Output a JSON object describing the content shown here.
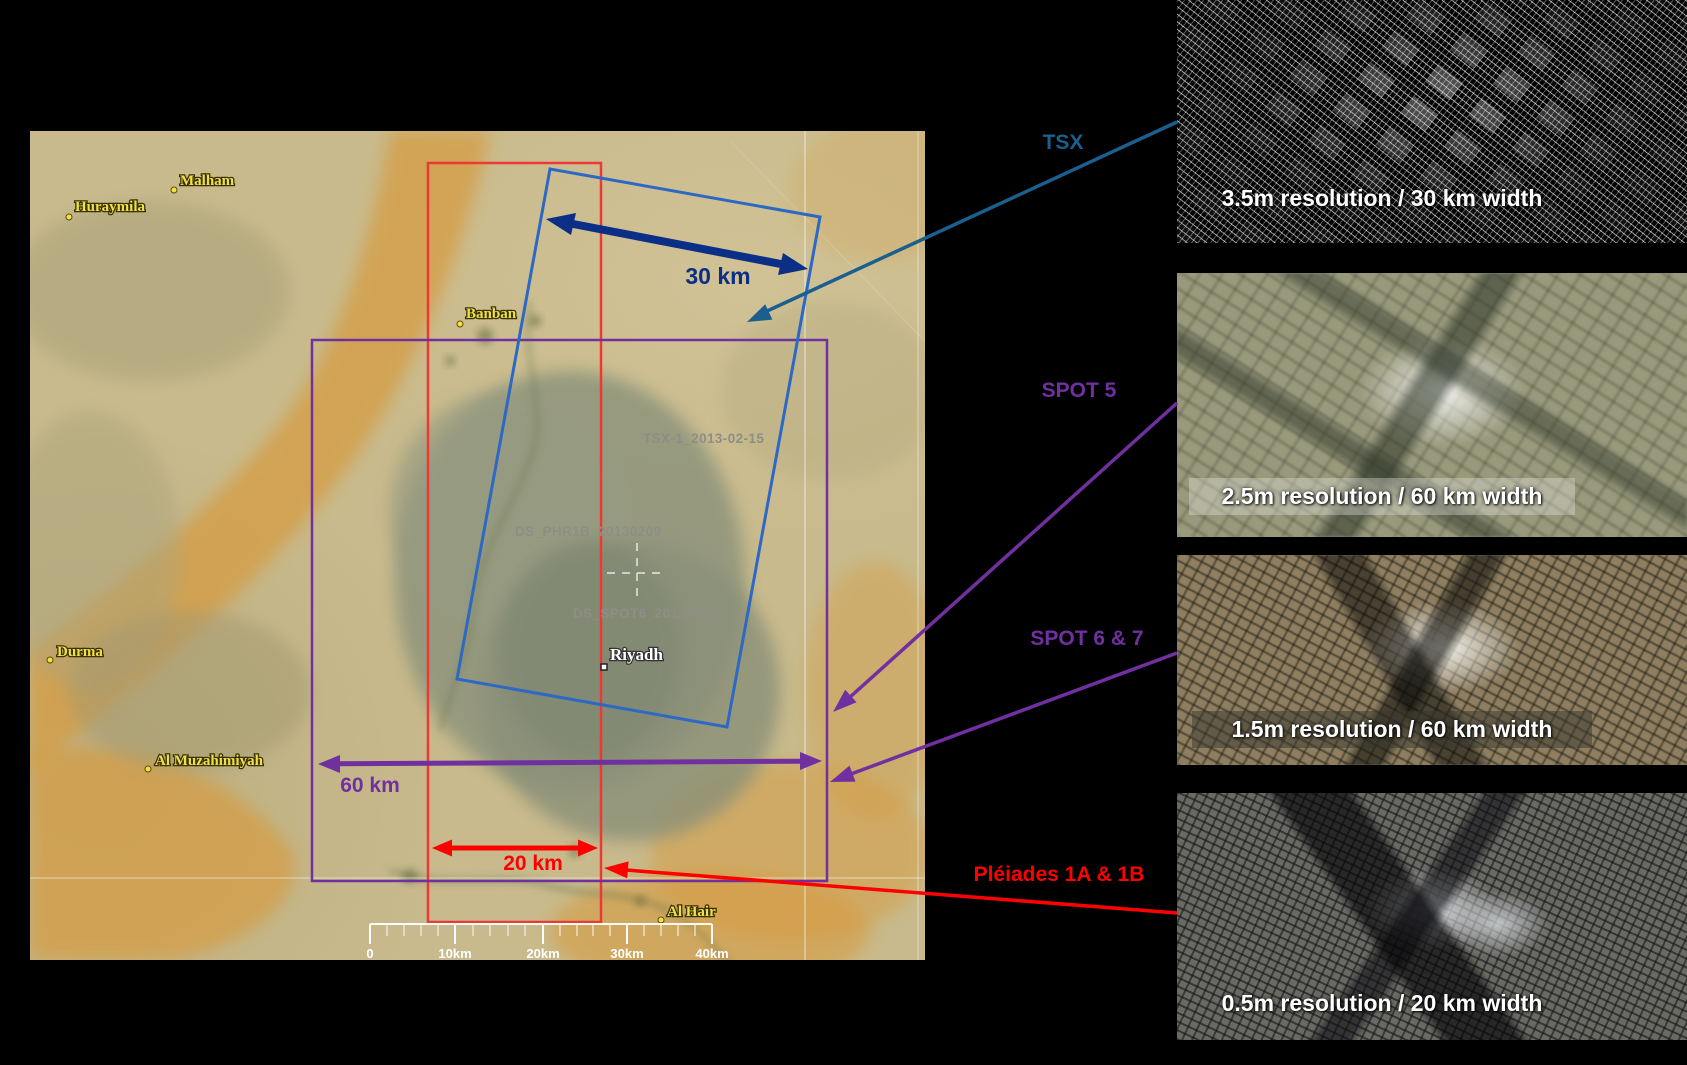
{
  "slide": {
    "background": "#000000",
    "map": {
      "places": [
        {
          "label": "Huraymila"
        },
        {
          "label": "Malham"
        },
        {
          "label": "Banban"
        },
        {
          "label": "Durma"
        },
        {
          "label": "Al Muzahimiyah"
        },
        {
          "label": "Al Hair"
        }
      ],
      "city": {
        "label": "Riyadh"
      },
      "scene_ids": [
        {
          "label": "TSX-1_2013-02-15"
        },
        {
          "label": "DS_PHR1B_20130209"
        },
        {
          "label": "DS_SPOT6_20130216"
        }
      ],
      "measurements": {
        "tsx_width": "30 km",
        "spot_width": "60 km",
        "pleiades_width": "20 km"
      },
      "scalebar": {
        "labels": [
          "0",
          "10km",
          "20km",
          "30km",
          "40km"
        ]
      },
      "footprints": {
        "tsx": {
          "color": "#2d68c4"
        },
        "spot": {
          "color": "#7030a0"
        },
        "pleiades": {
          "color": "#ed3833"
        }
      }
    },
    "satellites": [
      {
        "name": "TSX",
        "color": "#1b5f8e",
        "caption": "3.5m resolution / 30 km width"
      },
      {
        "name": "SPOT 5",
        "color": "#7030a0",
        "caption": "2.5m resolution / 60 km width"
      },
      {
        "name": "SPOT 6 & 7",
        "color": "#7030a0",
        "caption": "1.5m resolution / 60 km width"
      },
      {
        "name": "Pléiades 1A & 1B",
        "color": "#ff0000",
        "caption": "0.5m resolution / 20 km width"
      }
    ]
  }
}
